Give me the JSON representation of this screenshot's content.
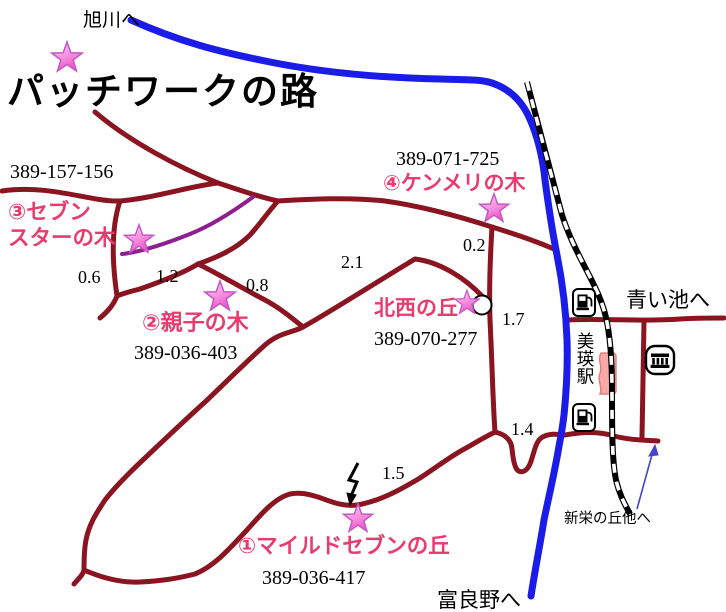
{
  "map": {
    "title": "パッチワークの路",
    "directions": {
      "asahikawa": "旭川へ",
      "aoiike": "青い池へ",
      "furano": "富良野へ",
      "shinei": "新栄の丘他へ"
    },
    "station": {
      "name": "美瑛駅"
    },
    "spots": {
      "mild_seven": {
        "label": "①マイルドセブンの丘",
        "mapcode": "389-036-417"
      },
      "oyako": {
        "label": "②親子の木",
        "mapcode": "389-036-403"
      },
      "seven_star": {
        "line1": "③セブン",
        "line2": "スターの木",
        "mapcode": "389-157-156"
      },
      "kenmeri": {
        "label": "④ケンメリの木",
        "mapcode": "389-071-725"
      },
      "hokusei": {
        "label": "北西の丘",
        "mapcode": "389-070-277"
      }
    },
    "distances": {
      "d1": "0.6",
      "d2": "1.2",
      "d3": "0.8",
      "d4": "2.1",
      "d5": "0.2",
      "d6": "1.7",
      "d7": "1.4",
      "d8": "1.5"
    },
    "colors": {
      "road": "#8a1420",
      "scenic_route": "#8d1f8f",
      "river": "#1c1ce8",
      "railway": "#000000",
      "spot_label": "#ea3a6e",
      "star_fill": "#f473d8",
      "star_edge": "#c45ac4",
      "station_fill": "#f9a8a8",
      "arrow_blue": "#4444cc"
    },
    "icons": {
      "gas_station": "fuel-pump-icon",
      "public_building": "building-icon",
      "spot_marker": "star-icon",
      "viewpoint": "circle-marker",
      "road_point": "zigzag-arrow-icon"
    }
  }
}
